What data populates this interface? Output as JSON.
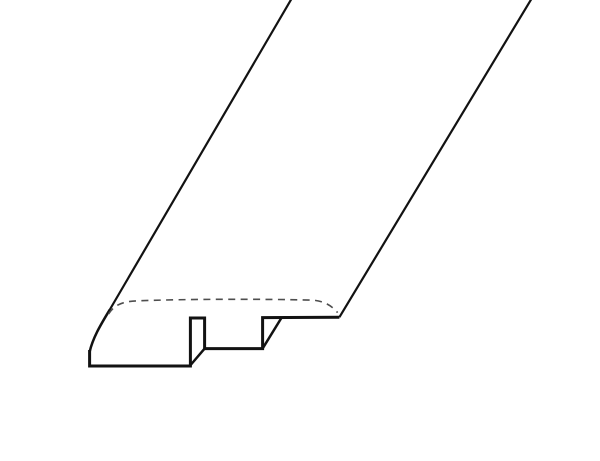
{
  "canvas": {
    "width": 600,
    "height": 461,
    "background": "#ffffff"
  },
  "drawing": {
    "subject": "flooring-reducer-molding-profile-line-drawing",
    "ink_color": "#121212",
    "hidden_edge_color": "#4e4e4e",
    "paths": [
      {
        "name": "plank-left-long-edge",
        "d": "M 292 -2 L 109 311",
        "stroke": "#121212",
        "width": 2.2
      },
      {
        "name": "bullnose-curve-edge",
        "d": "M 109.8 309.6 C 101.5 323.5 93 337 89.6 352",
        "stroke": "#121212",
        "width": 2.5
      },
      {
        "name": "front-profile-outline",
        "d": "M 89.6 350 L 89.6 366 L 190.4 366 L 190.4 318 L 204.6 318 L 204.6 348.6 L 262.6 348.6 L 262.6 317.6 L 339.4 317.2",
        "stroke": "#121212",
        "width": 3
      },
      {
        "name": "plank-right-long-edge",
        "d": "M 339.4 317.2 L 532 -2",
        "stroke": "#121212",
        "width": 2.2
      },
      {
        "name": "tongue-base-depth-edge",
        "d": "M 190.6 365 L 204.4 348.8",
        "stroke": "#121212",
        "width": 2.5
      },
      {
        "name": "groove-wall-depth-edge",
        "d": "M 262.8 348.2 L 281.6 317.6",
        "stroke": "#121212",
        "width": 2.5
      },
      {
        "name": "roundover-hidden-edge",
        "d": "M 108.6 314 C 114.5 304.5 123 301.4 138 300.8 C 190 298.9 262 298.9 312 300.1 C 322.5 300.6 331 304.8 337.6 312.6",
        "stroke": "#4e4e4e",
        "width": 1.6,
        "dash": "7 5.4"
      }
    ]
  }
}
